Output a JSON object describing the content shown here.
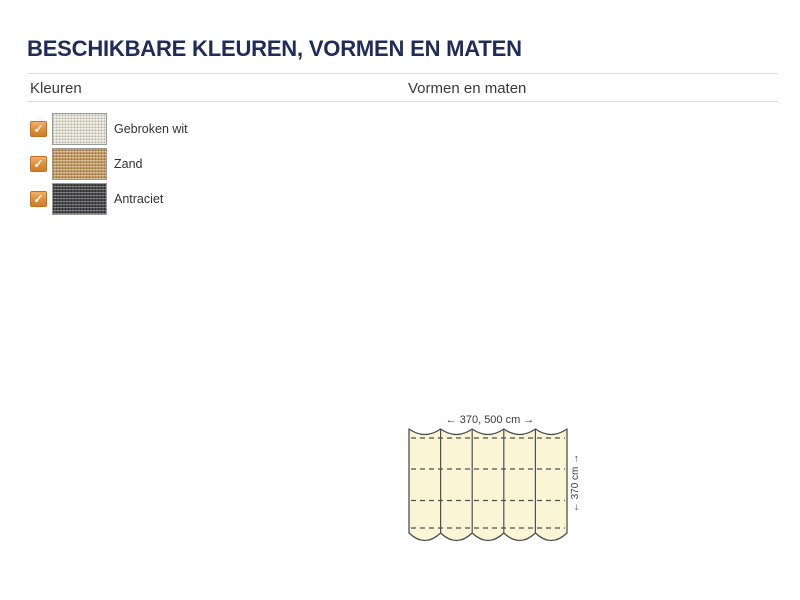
{
  "page": {
    "title": "BESCHIKBARE KLEUREN, VORMEN EN MATEN"
  },
  "table": {
    "columns": [
      {
        "label": "Kleuren"
      },
      {
        "label": "Vormen en maten"
      }
    ]
  },
  "colors": {
    "items": [
      {
        "label": "Gebroken wit",
        "swatch_hex": "#e9e6d8",
        "checked": true
      },
      {
        "label": "Zand",
        "swatch_hex": "#c5995a",
        "checked": true
      },
      {
        "label": "Antraciet",
        "swatch_hex": "#3a3a3c",
        "checked": true
      }
    ],
    "check_icon_glyph": "✓"
  },
  "diagram": {
    "type": "harmonica-cloth-size-diagram",
    "width_label": "← 370, 500 cm →",
    "height_label": "← 370 cm →",
    "panels": 5,
    "fill_hex": "#faf6d5",
    "line_hex": "#4f4f51"
  },
  "theme": {
    "title_hex": "#1f2b58",
    "accent_orange_hex": "#e0872e",
    "divider_hex": "#dddddd"
  }
}
